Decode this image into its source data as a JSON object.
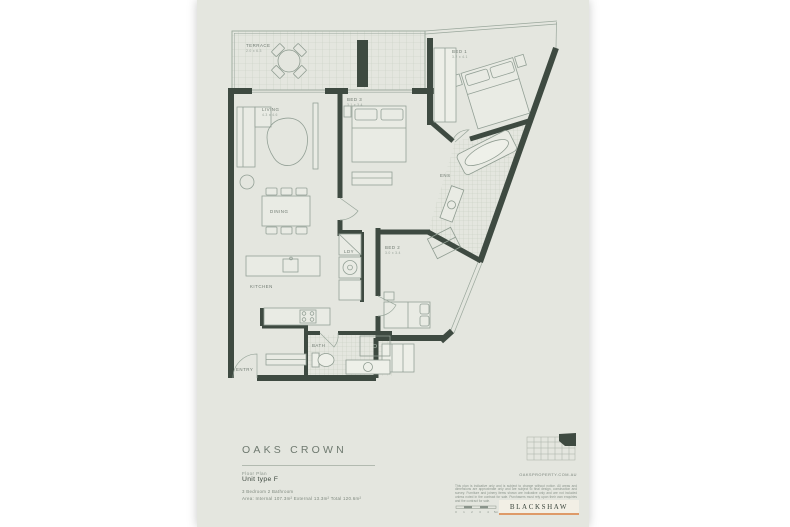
{
  "colors": {
    "page_bg": "#e4e6df",
    "wall": "#3e4a41",
    "line": "#9aa79c",
    "tile": "#c7cec2",
    "label_text": "#6f7a71",
    "accent_orange": "#de9a68",
    "logo_band": "#f2efe5"
  },
  "plan": {
    "rooms": [
      {
        "name": "TERRACE",
        "dims": "2.0 x 6.3"
      },
      {
        "name": "LIVING",
        "dims": "4.3 x 4.6"
      },
      {
        "name": "DINING",
        "dims": ""
      },
      {
        "name": "KITCHEN",
        "dims": ""
      },
      {
        "name": "BED 3",
        "dims": "3.1 x 3.4"
      },
      {
        "name": "BED 1",
        "dims": "3.2 x 4.1"
      },
      {
        "name": "BED 2",
        "dims": "3.0 x 3.4"
      },
      {
        "name": "ENS",
        "dims": ""
      },
      {
        "name": "BATH",
        "dims": ""
      },
      {
        "name": "LDY",
        "dims": ""
      },
      {
        "name": "ENTRY",
        "dims": ""
      }
    ]
  },
  "title_block": {
    "project": "OAKS CROWN",
    "sheet_label": "Floor Plan",
    "unit_type": "Unit type F",
    "configuration": "3 Bedroom   2 Bathroom",
    "areas": "Area: Internal 107.3m²   External 13.3m²   Total 120.6m²",
    "website": "OAKSPROPERTY.COM.AU",
    "disclaimer": "This plan is indicative only and is subject to change without notice. All areas and dimensions are approximate only and are subject to final design, construction and survey. Furniture and joinery items shown are indicative only and are not included unless noted in the contract for sale. Purchasers must rely upon their own enquiries and the contract for sale.",
    "brand": "BLACKSHAW",
    "scale_ticks": [
      "0",
      "1",
      "2",
      "3",
      "4",
      "5m"
    ]
  }
}
